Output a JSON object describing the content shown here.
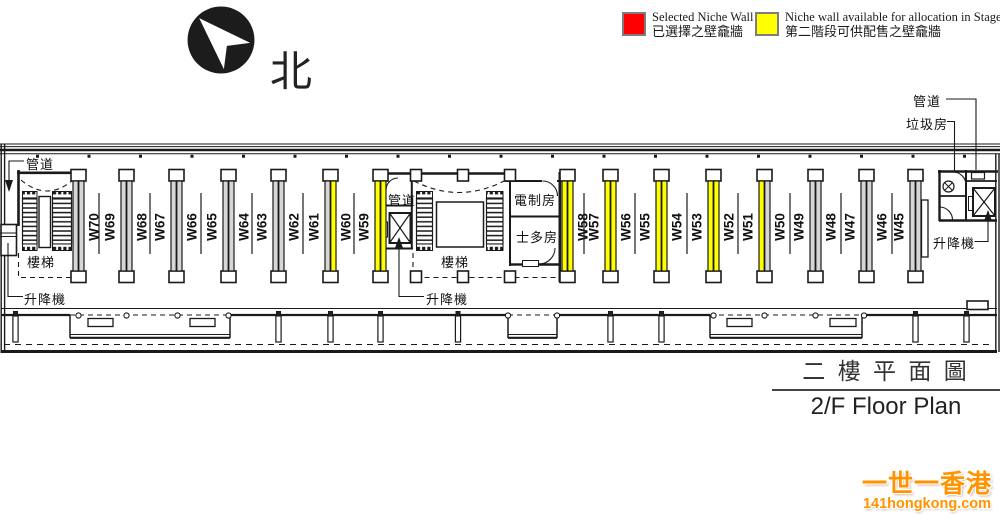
{
  "legend": {
    "items": [
      {
        "color": "#ff0000",
        "status_key": "selected",
        "label_en": "Selected Niche Wall",
        "label_zh": "已選擇之壁龕牆"
      },
      {
        "color": "#ffff00",
        "status_key": "available",
        "label_en": "Niche wall available for allocation in Stage II",
        "label_zh": "第二階段可供配售之壁龕牆"
      }
    ]
  },
  "compass": {
    "label": "北"
  },
  "title": {
    "zh": "二 樓 平 面 圖",
    "en": "2/F Floor Plan"
  },
  "watermark": {
    "line1": "一世一香港",
    "line2": "141hongkong.com"
  },
  "plan": {
    "labels": {
      "duct": "管道",
      "stairs": "樓梯",
      "lift": "升降機",
      "refuse": "垃圾房",
      "electrical": "電制房",
      "store": "士多房"
    },
    "colors": {
      "available": "#ffff00",
      "unallocated": "#d6d6d6",
      "selected": "#ff0000"
    },
    "bars": [
      {
        "x": 73,
        "right": {
          "label": "W70",
          "status": "unallocated"
        }
      },
      {
        "x": 121,
        "left": {
          "label": "W69",
          "status": "unallocated"
        },
        "right": {
          "label": "W68",
          "status": "unallocated"
        }
      },
      {
        "x": 171,
        "left": {
          "label": "W67",
          "status": "unallocated"
        },
        "right": {
          "label": "W66",
          "status": "unallocated"
        }
      },
      {
        "x": 223,
        "left": {
          "label": "W65",
          "status": "unallocated"
        },
        "right": {
          "label": "W64",
          "status": "unallocated"
        }
      },
      {
        "x": 273,
        "left": {
          "label": "W63",
          "status": "unallocated"
        },
        "right": {
          "label": "W62",
          "status": "unallocated"
        }
      },
      {
        "x": 325,
        "left": {
          "label": "W61",
          "status": "unallocated"
        },
        "right": {
          "label": "W60",
          "status": "available"
        }
      },
      {
        "x": 375,
        "left": {
          "label": "W59",
          "status": "available"
        }
      },
      {
        "x": 562,
        "right": {
          "label": "W58",
          "status": "available"
        }
      },
      {
        "x": 605,
        "left": {
          "label": "W57",
          "status": "available"
        },
        "right": {
          "label": "W56",
          "status": "available"
        }
      },
      {
        "x": 656,
        "left": {
          "label": "W55",
          "status": "available"
        },
        "right": {
          "label": "W54",
          "status": "available"
        }
      },
      {
        "x": 708,
        "left": {
          "label": "W53",
          "status": "available"
        },
        "right": {
          "label": "W52",
          "status": "available"
        }
      },
      {
        "x": 759,
        "left": {
          "label": "W51",
          "status": "available"
        },
        "right": {
          "label": "W50",
          "status": "unallocated"
        }
      },
      {
        "x": 810,
        "left": {
          "label": "W49",
          "status": "unallocated"
        },
        "right": {
          "label": "W48",
          "status": "unallocated"
        }
      },
      {
        "x": 861,
        "left": {
          "label": "W47",
          "status": "unallocated"
        },
        "right": {
          "label": "W46",
          "status": "unallocated"
        }
      },
      {
        "x": 910,
        "left": {
          "label": "W45",
          "status": "unallocated"
        }
      }
    ],
    "separators": [
      99,
      150,
      201,
      252,
      303,
      354,
      584,
      635,
      687,
      738,
      790,
      841,
      892
    ]
  }
}
